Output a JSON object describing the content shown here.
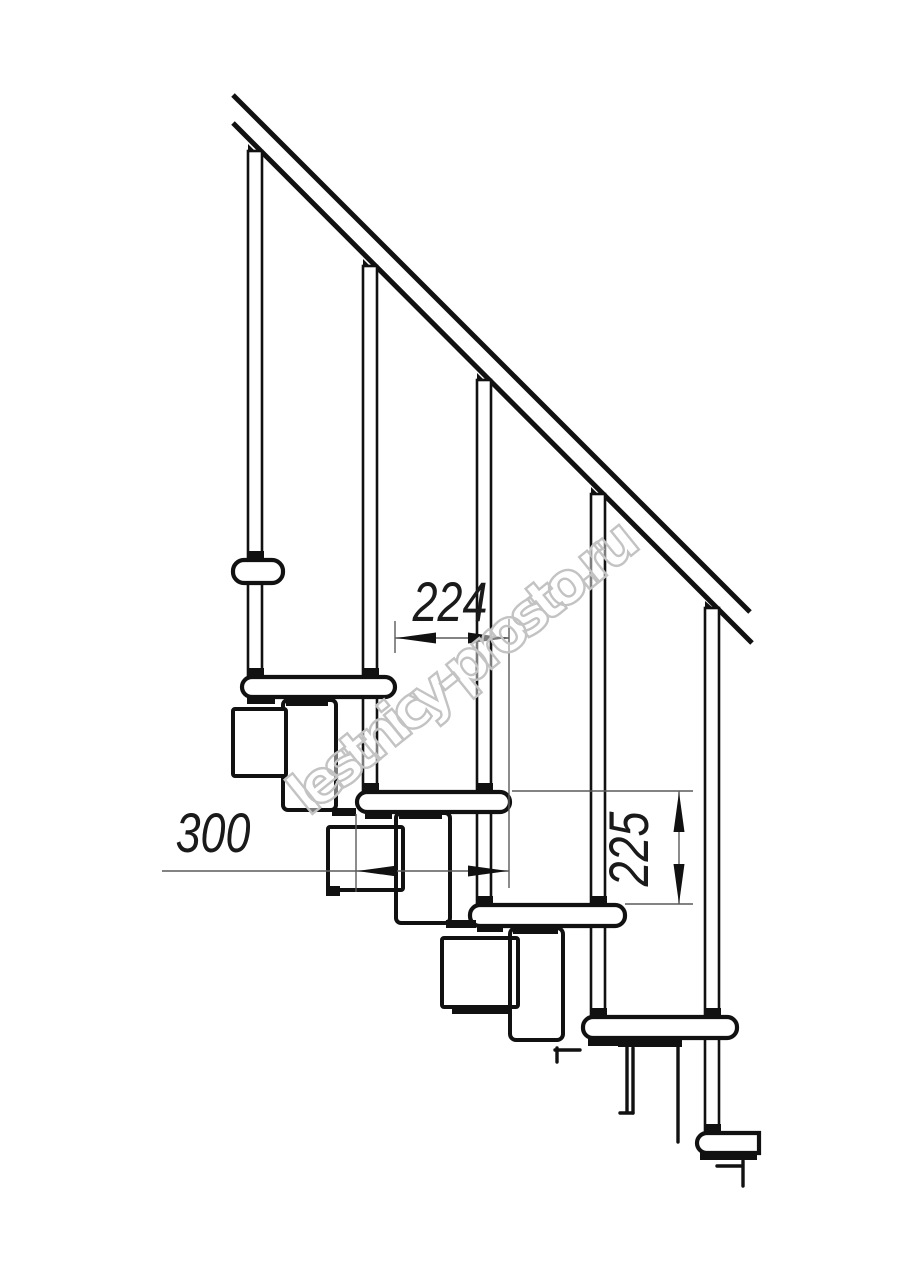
{
  "drawing": {
    "dimensions": {
      "tread_overlap_horizontal": "224",
      "tread_depth": "300",
      "riser_height": "225"
    },
    "watermark": {
      "text": "lestnicy-prosto.ru",
      "color": "#c3c3c3"
    },
    "colors": {
      "line": "#111111",
      "dimension_line": "#5a5a5a",
      "background": "#ffffff"
    }
  }
}
